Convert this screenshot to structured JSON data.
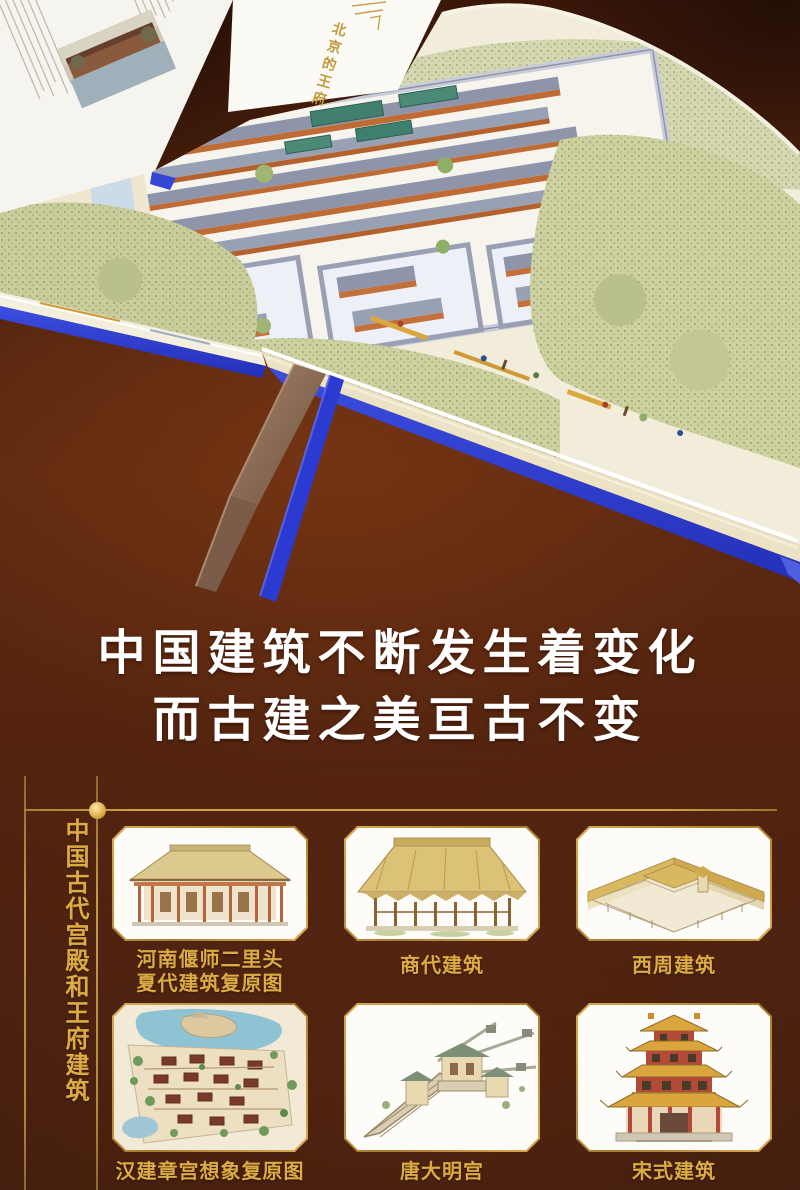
{
  "headline": {
    "line1": "中国建筑不断发生着变化",
    "line2": "而古建之美亘古不变"
  },
  "book": {
    "chapter_label": "北京的王府"
  },
  "section": {
    "vertical_title": "中国古代宫殿和王府建筑",
    "tiles": [
      {
        "caption_line1": "河南偃师二里头",
        "caption_line2": "夏代建筑复原图"
      },
      {
        "caption_line1": "商代建筑",
        "caption_line2": ""
      },
      {
        "caption_line1": "西周建筑",
        "caption_line2": ""
      },
      {
        "caption_line1": "汉建章宫想象复原图",
        "caption_line2": ""
      },
      {
        "caption_line1": "唐大明宫",
        "caption_line2": ""
      },
      {
        "caption_line1": "宋式建筑",
        "caption_line2": ""
      }
    ]
  },
  "colors": {
    "background_brown": "#54240f",
    "accent_gold": "#d9aa45",
    "cover_blue": "#2e3ed2",
    "headline_white": "#ffffff"
  }
}
